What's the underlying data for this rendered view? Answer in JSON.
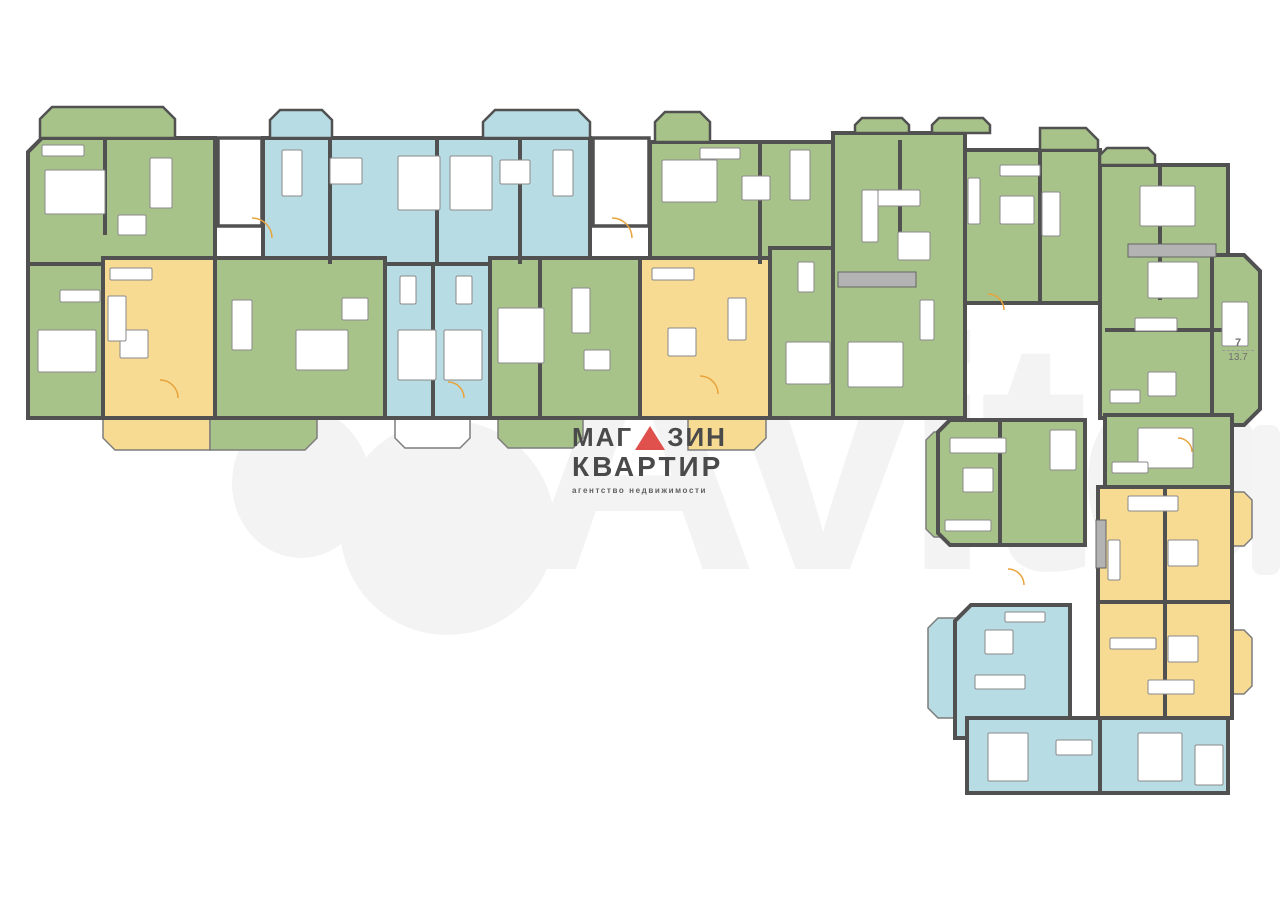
{
  "watermark": {
    "text": "Avito"
  },
  "logo": {
    "line1_left": "МАГ",
    "line1_right": "ЗИН",
    "line2": "КВАРТИР",
    "line3": "агентство недвижимости",
    "text_color": "#4a4a4a",
    "triangle_color": "#e0514e"
  },
  "room_label": {
    "number": "7",
    "area": "13.7"
  },
  "palette": {
    "green": "#a8c389",
    "blue": "#b8dce4",
    "yellow": "#f7db92",
    "wall": "#515151",
    "balcony_stroke": "#7d7d7d",
    "furniture_stroke": "#8a8a8a",
    "hatch_fill": "#b3b3b3",
    "hatch_stroke": "#646464",
    "door": "#e8a33d",
    "watermark": "#f3f3f3"
  },
  "floorplan": {
    "units": [
      {
        "name": "unit-a1-green",
        "color": "green",
        "rect": [
          28,
          138,
          187,
          126
        ],
        "cuts": {
          "tl": 14
        }
      },
      {
        "name": "unit-a2-blue",
        "color": "blue",
        "rect": [
          263,
          138,
          327,
          126
        ]
      },
      {
        "name": "unit-a3-blue-bedrooms",
        "color": "blue",
        "rect": [
          385,
          264,
          105,
          154
        ]
      },
      {
        "name": "unit-a4-green",
        "color": "green",
        "rect": [
          650,
          142,
          198,
          122
        ],
        "cuts": {
          "tr": 14
        }
      },
      {
        "name": "unit-a5-green",
        "color": "green",
        "rect": [
          28,
          264,
          75,
          154
        ]
      },
      {
        "name": "unit-a6-yellow",
        "color": "yellow",
        "rect": [
          103,
          258,
          112,
          160
        ]
      },
      {
        "name": "unit-a7-green",
        "color": "green",
        "rect": [
          215,
          258,
          170,
          160
        ]
      },
      {
        "name": "unit-a8-green",
        "color": "green",
        "rect": [
          490,
          258,
          150,
          160
        ]
      },
      {
        "name": "unit-a9-yellow",
        "color": "yellow",
        "rect": [
          640,
          258,
          130,
          160
        ]
      },
      {
        "name": "unit-a10-green",
        "color": "green",
        "rect": [
          770,
          248,
          78,
          170
        ]
      },
      {
        "name": "unit-b1-green",
        "color": "green",
        "rect": [
          833,
          133,
          132,
          285
        ]
      },
      {
        "name": "unit-b2-green",
        "color": "green",
        "rect": [
          965,
          150,
          135,
          153
        ]
      },
      {
        "name": "unit-b3-green",
        "color": "green",
        "rect": [
          1100,
          165,
          128,
          253
        ]
      },
      {
        "name": "unit-b4-green-bay",
        "color": "green",
        "rect": [
          1212,
          255,
          48,
          170
        ],
        "cuts": {
          "tr": 16,
          "br": 16
        }
      },
      {
        "name": "unit-c1-green",
        "color": "green",
        "rect": [
          938,
          420,
          147,
          125
        ],
        "cuts": {
          "tl": 12,
          "bl": 12
        }
      },
      {
        "name": "unit-c2-green",
        "color": "green",
        "rect": [
          1105,
          415,
          127,
          72
        ]
      },
      {
        "name": "unit-c3-yellow",
        "color": "yellow",
        "rect": [
          1098,
          487,
          134,
          115
        ]
      },
      {
        "name": "unit-c4-yellow",
        "color": "yellow",
        "rect": [
          1098,
          602,
          134,
          116
        ]
      },
      {
        "name": "unit-c5-blue",
        "color": "blue",
        "rect": [
          955,
          605,
          115,
          133
        ],
        "cuts": {
          "tl": 16
        }
      },
      {
        "name": "unit-c6-blue",
        "color": "blue",
        "rect": [
          967,
          718,
          261,
          75
        ]
      }
    ],
    "balconies": [
      {
        "color": "yellow",
        "rect": [
          103,
          418,
          107,
          32
        ],
        "cuts": {
          "bl": 12
        }
      },
      {
        "color": "green",
        "rect": [
          210,
          418,
          107,
          32
        ],
        "cuts": {
          "br": 12
        }
      },
      {
        "color": "white",
        "rect": [
          395,
          418,
          75,
          30
        ],
        "cuts": {
          "bl": 10,
          "br": 10
        }
      },
      {
        "color": "green",
        "rect": [
          498,
          418,
          85,
          30
        ],
        "cuts": {
          "bl": 10,
          "br": 10
        }
      },
      {
        "color": "yellow",
        "rect": [
          688,
          418,
          78,
          32
        ],
        "cuts": {
          "br": 12
        }
      },
      {
        "color": "green",
        "rect": [
          926,
          432,
          14,
          105
        ],
        "cuts": {
          "tl": 8,
          "bl": 8
        }
      },
      {
        "color": "blue",
        "rect": [
          928,
          618,
          28,
          100
        ],
        "cuts": {
          "tl": 10,
          "bl": 10
        }
      },
      {
        "color": "yellow",
        "rect": [
          1232,
          492,
          20,
          54
        ],
        "cuts": {
          "tr": 8,
          "br": 8
        }
      },
      {
        "color": "yellow",
        "rect": [
          1232,
          630,
          20,
          64
        ],
        "cuts": {
          "tr": 8,
          "br": 8
        }
      }
    ],
    "bays": [
      {
        "color": "green",
        "rect": [
          40,
          107,
          135,
          31
        ],
        "cuts": {
          "tl": 12,
          "tr": 12
        }
      },
      {
        "color": "blue",
        "rect": [
          270,
          110,
          62,
          28
        ],
        "cuts": {
          "tl": 10,
          "tr": 10
        }
      },
      {
        "color": "blue",
        "rect": [
          483,
          110,
          107,
          28
        ],
        "cuts": {
          "tl": 12,
          "tr": 12
        }
      },
      {
        "color": "green",
        "rect": [
          655,
          112,
          55,
          30
        ],
        "cuts": {
          "tl": 10,
          "tr": 10
        }
      },
      {
        "color": "green",
        "rect": [
          855,
          118,
          54,
          15
        ],
        "cuts": {
          "tl": 7,
          "tr": 7
        }
      },
      {
        "color": "green",
        "rect": [
          932,
          118,
          58,
          15
        ],
        "cuts": {
          "tl": 7,
          "tr": 7
        }
      },
      {
        "color": "green",
        "rect": [
          1040,
          128,
          58,
          22
        ],
        "cuts": {
          "tr": 12
        }
      },
      {
        "color": "green",
        "rect": [
          1100,
          148,
          55,
          17
        ],
        "cuts": {
          "tl": 7,
          "tr": 7
        }
      }
    ],
    "entries": [
      [
        218,
        138,
        44,
        88
      ],
      [
        593,
        138,
        56,
        88
      ]
    ],
    "hatches": [
      [
        838,
        272,
        78,
        15
      ],
      [
        1128,
        244,
        88,
        13
      ],
      [
        1096,
        520,
        10,
        48
      ]
    ],
    "walls": [
      [
        105,
        138,
        105,
        235
      ],
      [
        330,
        138,
        330,
        264
      ],
      [
        437,
        138,
        437,
        264
      ],
      [
        520,
        138,
        520,
        264
      ],
      [
        760,
        142,
        760,
        264
      ],
      [
        900,
        140,
        900,
        240
      ],
      [
        1040,
        150,
        1040,
        303
      ],
      [
        1160,
        165,
        1160,
        300
      ],
      [
        1105,
        330,
        1228,
        330
      ],
      [
        1000,
        420,
        1000,
        545
      ],
      [
        1165,
        487,
        1165,
        602
      ],
      [
        1165,
        602,
        1165,
        718
      ],
      [
        1100,
        718,
        1100,
        793
      ],
      [
        433,
        264,
        433,
        418
      ],
      [
        540,
        258,
        540,
        418
      ]
    ],
    "furniture": [
      [
        45,
        170,
        60,
        44
      ],
      [
        150,
        158,
        22,
        50
      ],
      [
        118,
        215,
        28,
        20
      ],
      [
        42,
        145,
        42,
        11
      ],
      [
        282,
        150,
        20,
        46
      ],
      [
        330,
        158,
        32,
        26
      ],
      [
        398,
        156,
        42,
        54
      ],
      [
        450,
        156,
        42,
        54
      ],
      [
        553,
        150,
        20,
        46
      ],
      [
        500,
        160,
        30,
        24
      ],
      [
        662,
        160,
        55,
        42
      ],
      [
        790,
        150,
        20,
        50
      ],
      [
        742,
        176,
        28,
        24
      ],
      [
        700,
        148,
        40,
        11
      ],
      [
        398,
        330,
        38,
        50
      ],
      [
        444,
        330,
        38,
        50
      ],
      [
        400,
        276,
        16,
        28
      ],
      [
        456,
        276,
        16,
        28
      ],
      [
        38,
        330,
        58,
        42
      ],
      [
        60,
        290,
        40,
        12
      ],
      [
        120,
        330,
        28,
        28
      ],
      [
        108,
        296,
        18,
        45
      ],
      [
        110,
        268,
        42,
        12
      ],
      [
        232,
        300,
        20,
        50
      ],
      [
        296,
        330,
        52,
        40
      ],
      [
        342,
        298,
        26,
        22
      ],
      [
        498,
        308,
        46,
        55
      ],
      [
        572,
        288,
        18,
        45
      ],
      [
        584,
        350,
        26,
        20
      ],
      [
        668,
        328,
        28,
        28
      ],
      [
        652,
        268,
        42,
        12
      ],
      [
        728,
        298,
        18,
        42
      ],
      [
        798,
        262,
        16,
        30
      ],
      [
        786,
        342,
        44,
        42
      ],
      [
        862,
        190,
        58,
        16
      ],
      [
        862,
        190,
        16,
        52
      ],
      [
        898,
        232,
        32,
        28
      ],
      [
        848,
        342,
        55,
        45
      ],
      [
        920,
        300,
        14,
        40
      ],
      [
        1000,
        196,
        34,
        28
      ],
      [
        968,
        178,
        12,
        46
      ],
      [
        1042,
        192,
        18,
        44
      ],
      [
        1000,
        165,
        40,
        11
      ],
      [
        1140,
        186,
        55,
        40
      ],
      [
        1148,
        262,
        50,
        36
      ],
      [
        1135,
        318,
        42,
        13
      ],
      [
        1148,
        372,
        28,
        24
      ],
      [
        1110,
        390,
        30,
        13
      ],
      [
        1222,
        302,
        26,
        44
      ],
      [
        950,
        438,
        56,
        15
      ],
      [
        963,
        468,
        30,
        24
      ],
      [
        945,
        520,
        46,
        11
      ],
      [
        1050,
        430,
        26,
        40
      ],
      [
        1138,
        428,
        55,
        40
      ],
      [
        1112,
        462,
        36,
        11
      ],
      [
        1128,
        496,
        50,
        15
      ],
      [
        1168,
        540,
        30,
        26
      ],
      [
        1108,
        540,
        12,
        40
      ],
      [
        1110,
        638,
        46,
        11
      ],
      [
        1168,
        636,
        30,
        26
      ],
      [
        1148,
        680,
        46,
        14
      ],
      [
        985,
        630,
        28,
        24
      ],
      [
        975,
        675,
        50,
        14
      ],
      [
        1005,
        612,
        40,
        10
      ],
      [
        988,
        733,
        40,
        48
      ],
      [
        1056,
        740,
        36,
        15
      ],
      [
        1138,
        733,
        44,
        48
      ],
      [
        1195,
        745,
        28,
        40
      ]
    ],
    "doors": [
      [
        252,
        238,
        20
      ],
      [
        612,
        238,
        20
      ],
      [
        160,
        398,
        18
      ],
      [
        448,
        398,
        16
      ],
      [
        700,
        394,
        18
      ],
      [
        1008,
        585,
        16
      ],
      [
        988,
        310,
        16
      ],
      [
        1178,
        452,
        14
      ]
    ]
  }
}
